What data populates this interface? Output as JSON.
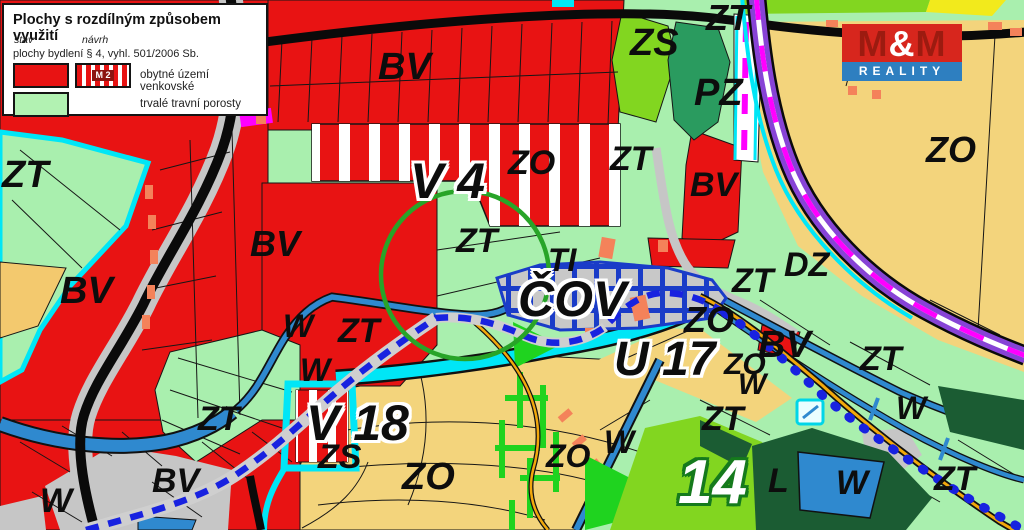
{
  "legend": {
    "title": "Plochy s rozdílným způsobem využití",
    "col_stav": "stav",
    "col_navrh": "návrh",
    "section": "plochy bydlení § 4, vyhl. 501/2006 Sb.",
    "entries": [
      {
        "label": "obytné území venkovské",
        "navrh_code": "M 2"
      },
      {
        "label": "trvalé travní porosty",
        "navrh_code": ""
      }
    ]
  },
  "logo": {
    "m1": "M",
    "amp": "&",
    "m2": "M",
    "sub": "REALITY"
  },
  "map": {
    "zone_colors": {
      "residential_red": "#e81313",
      "grassland_green": "#a9efae",
      "orchard_tan": "#f3d47c",
      "public_green_bright": "#82d620",
      "park_dark_teal": "#2a9b5f",
      "forest_dark_green": "#1b5c33",
      "water_blue": "#2f89cf",
      "stream_cyan": "#00e6f6",
      "rail_purple": "#8743d6",
      "rail_magenta": "#ff00ff",
      "utility_blue_dash": "#1822e0",
      "road_orange": "#f2a80c",
      "impervious_gray": "#c6c6c6",
      "marker_salmon": "#f4825a",
      "circle_green": "#28a428",
      "tree_bright_green": "#1fd31f"
    },
    "labels": [
      {
        "text": "ZT",
        "x": 2,
        "y": 156,
        "s": 38
      },
      {
        "text": "BV",
        "x": 60,
        "y": 272,
        "s": 38
      },
      {
        "text": "BV",
        "x": 250,
        "y": 226,
        "s": 36
      },
      {
        "text": "W",
        "x": 283,
        "y": 310,
        "s": 32
      },
      {
        "text": "ZT",
        "x": 338,
        "y": 314,
        "s": 34
      },
      {
        "text": "W",
        "x": 300,
        "y": 354,
        "s": 32
      },
      {
        "text": "BV",
        "x": 378,
        "y": 48,
        "s": 38
      },
      {
        "text": "ZO",
        "x": 508,
        "y": 146,
        "s": 34
      },
      {
        "text": "ZT",
        "x": 610,
        "y": 142,
        "s": 34
      },
      {
        "text": "V 4",
        "x": 410,
        "y": 156,
        "s": 50,
        "style": "halo"
      },
      {
        "text": "ZT",
        "x": 456,
        "y": 224,
        "s": 34
      },
      {
        "text": "TI",
        "x": 548,
        "y": 244,
        "s": 32
      },
      {
        "text": "ČOV",
        "x": 518,
        "y": 274,
        "s": 50,
        "style": "halo"
      },
      {
        "text": "ZS",
        "x": 630,
        "y": 24,
        "s": 38
      },
      {
        "text": "ZT",
        "x": 706,
        "y": 0,
        "s": 36
      },
      {
        "text": "PZ",
        "x": 694,
        "y": 74,
        "s": 38
      },
      {
        "text": "BV",
        "x": 690,
        "y": 168,
        "s": 34
      },
      {
        "text": "ZO",
        "x": 926,
        "y": 132,
        "s": 36
      },
      {
        "text": "DZ",
        "x": 784,
        "y": 248,
        "s": 34
      },
      {
        "text": "ZT",
        "x": 732,
        "y": 264,
        "s": 34
      },
      {
        "text": "ZO",
        "x": 684,
        "y": 302,
        "s": 36
      },
      {
        "text": "BV",
        "x": 758,
        "y": 326,
        "s": 38
      },
      {
        "text": "U 17",
        "x": 614,
        "y": 336,
        "s": 48,
        "style": "halo"
      },
      {
        "text": "ZO",
        "x": 724,
        "y": 350,
        "s": 30
      },
      {
        "text": "W",
        "x": 738,
        "y": 370,
        "s": 30
      },
      {
        "text": "ZT",
        "x": 702,
        "y": 402,
        "s": 34
      },
      {
        "text": "ZT",
        "x": 860,
        "y": 342,
        "s": 34
      },
      {
        "text": "W",
        "x": 896,
        "y": 392,
        "s": 32
      },
      {
        "text": "ZT",
        "x": 198,
        "y": 402,
        "s": 34
      },
      {
        "text": "V 18",
        "x": 306,
        "y": 398,
        "s": 50,
        "style": "halo"
      },
      {
        "text": "ZS",
        "x": 318,
        "y": 440,
        "s": 34
      },
      {
        "text": "ZO",
        "x": 402,
        "y": 458,
        "s": 38
      },
      {
        "text": "ZO",
        "x": 546,
        "y": 440,
        "s": 32
      },
      {
        "text": "W",
        "x": 604,
        "y": 426,
        "s": 32
      },
      {
        "text": "W",
        "x": 40,
        "y": 484,
        "s": 34
      },
      {
        "text": "BV",
        "x": 152,
        "y": 464,
        "s": 34
      },
      {
        "text": "14",
        "x": 678,
        "y": 452,
        "s": 62,
        "style": "halo14"
      },
      {
        "text": "L",
        "x": 768,
        "y": 464,
        "s": 34
      },
      {
        "text": "W",
        "x": 836,
        "y": 466,
        "s": 34
      },
      {
        "text": "ZT",
        "x": 934,
        "y": 462,
        "s": 34
      }
    ]
  }
}
